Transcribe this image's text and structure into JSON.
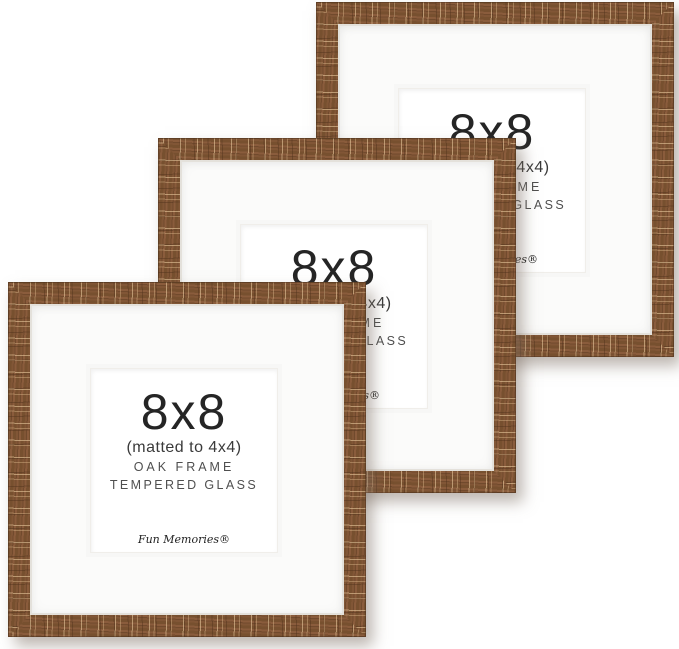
{
  "product": {
    "frame_count": 3,
    "label": {
      "size": "8x8",
      "matted": "(matted to 4x4)",
      "material": "OAK FRAME",
      "glass": "TEMPERED GLASS",
      "brand": "Fun Memories®"
    },
    "colors": {
      "wood_base": "#7d5334",
      "wood_dark": "#714a2d",
      "wood_streak_light": "#e0bd8f",
      "mat_white": "#fbfbfa",
      "insert_white": "#ffffff",
      "background": "#ffffff",
      "text_primary": "#252525",
      "text_secondary": "#4f4f4f"
    },
    "frames": [
      {
        "position": "back"
      },
      {
        "position": "middle"
      },
      {
        "position": "front"
      }
    ]
  }
}
